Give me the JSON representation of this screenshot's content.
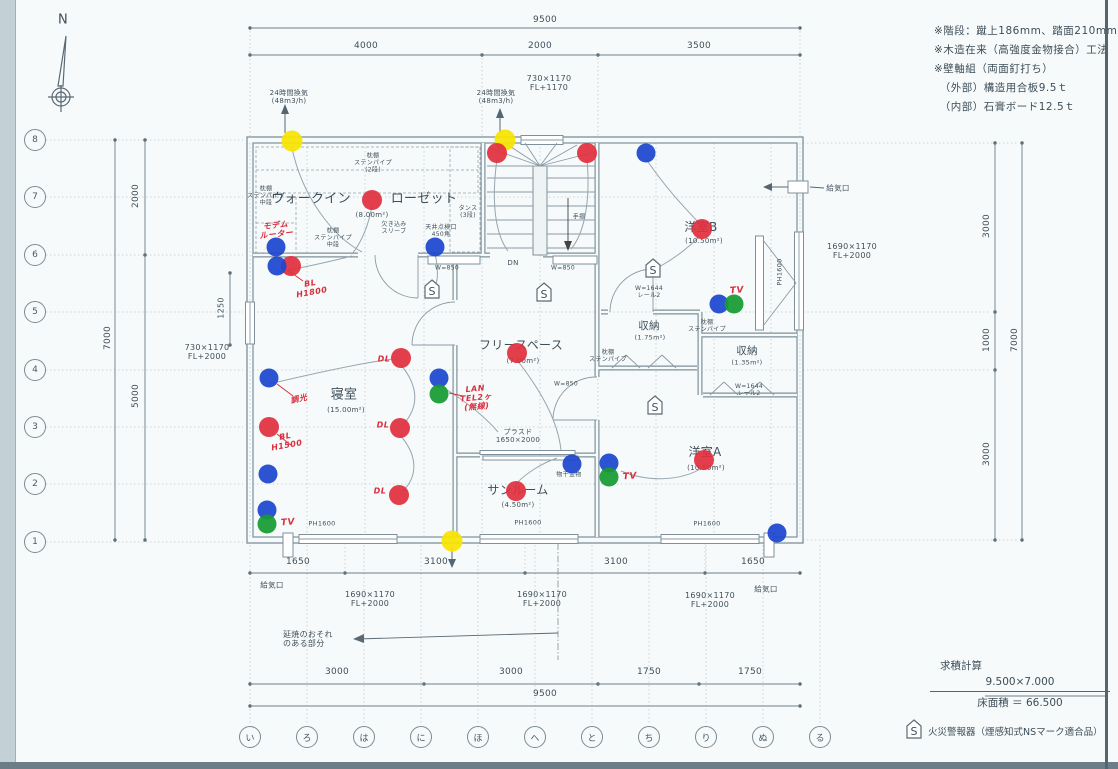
{
  "colors": {
    "red": "#e02f3e",
    "blue": "#1c46cf",
    "green": "#169b32",
    "yellow": "#f6e400",
    "line": "#7e909b",
    "text": "#3f4f5a",
    "hand": "#d9303f"
  },
  "compass": {
    "label": "N"
  },
  "notes": [
    "※階段：蹴上186mm、踏面210mm",
    "※木造在来（高強度金物接合）工法",
    "※壁軸組（両面釘打ち）",
    "　（外部）構造用合板9.5ｔ",
    "　（内部）石膏ボード12.5ｔ"
  ],
  "area_calc": {
    "title": "求積計算",
    "formula": "9.500×7.000",
    "result": "床面積 ＝ 66.500"
  },
  "legend": {
    "symbol": "S",
    "label": "火災警報器（煙感知式NSマーク適合品）"
  },
  "grid": {
    "rows": [
      "8",
      "7",
      "6",
      "5",
      "4",
      "3",
      "2",
      "1"
    ],
    "cols": [
      "い",
      "ろ",
      "は",
      "に",
      "ほ",
      "へ",
      "と",
      "ち",
      "り",
      "ぬ",
      "る"
    ]
  },
  "labels": [
    {
      "n": "dim-top-9500",
      "t": "9500",
      "x": 545,
      "y": 20,
      "s": 9
    },
    {
      "n": "dim-top-4000",
      "t": "4000",
      "x": 366,
      "y": 46,
      "s": 9
    },
    {
      "n": "dim-top-2000",
      "t": "2000",
      "x": 540,
      "y": 46,
      "s": 9
    },
    {
      "n": "dim-top-3500",
      "t": "3500",
      "x": 699,
      "y": 46,
      "s": 9
    },
    {
      "n": "dim-left-2000",
      "t": "2000",
      "x": 136,
      "y": 196,
      "s": 9,
      "r": -90
    },
    {
      "n": "dim-left-7000",
      "t": "7000",
      "x": 108,
      "y": 338,
      "s": 9,
      "r": -90
    },
    {
      "n": "dim-left-5000",
      "t": "5000",
      "x": 136,
      "y": 396,
      "s": 9,
      "r": -90
    },
    {
      "n": "dim-left-1250",
      "t": "1250",
      "x": 221,
      "y": 308,
      "s": 8,
      "r": -90
    },
    {
      "n": "dim-right-3000a",
      "t": "3000",
      "x": 987,
      "y": 226,
      "s": 9,
      "r": -90
    },
    {
      "n": "dim-right-1000",
      "t": "1000",
      "x": 987,
      "y": 340,
      "s": 9,
      "r": -90
    },
    {
      "n": "dim-right-3000b",
      "t": "3000",
      "x": 987,
      "y": 454,
      "s": 9,
      "r": -90
    },
    {
      "n": "dim-right-7000",
      "t": "7000",
      "x": 1015,
      "y": 340,
      "s": 9,
      "r": -90
    },
    {
      "n": "dim-bm-1650-l",
      "t": "1650",
      "x": 298,
      "y": 562,
      "s": 9
    },
    {
      "n": "dim-bm-3100-l",
      "t": "3100",
      "x": 436,
      "y": 562,
      "s": 9
    },
    {
      "n": "dim-bm-3100-r",
      "t": "3100",
      "x": 616,
      "y": 562,
      "s": 9
    },
    {
      "n": "dim-bm-1650-r",
      "t": "1650",
      "x": 753,
      "y": 562,
      "s": 9
    },
    {
      "n": "dim-b-3000-l",
      "t": "3000",
      "x": 337,
      "y": 672,
      "s": 9
    },
    {
      "n": "dim-b-3000-m",
      "t": "3000",
      "x": 511,
      "y": 672,
      "s": 9
    },
    {
      "n": "dim-b-1750-l",
      "t": "1750",
      "x": 649,
      "y": 672,
      "s": 9
    },
    {
      "n": "dim-b-1750-r",
      "t": "1750",
      "x": 750,
      "y": 672,
      "s": 9
    },
    {
      "n": "dim-b-9500",
      "t": "9500",
      "x": 545,
      "y": 694,
      "s": 9
    },
    {
      "n": "win-top",
      "t": "730×1170\nFL+1170",
      "x": 549,
      "y": 83,
      "s": 8
    },
    {
      "n": "win-left",
      "t": "730×1170\nFL+2000",
      "x": 207,
      "y": 352,
      "s": 8
    },
    {
      "n": "win-right",
      "t": "1690×1170\nFL+2000",
      "x": 852,
      "y": 251,
      "s": 8
    },
    {
      "n": "win-b1",
      "t": "1690×1170\nFL+2000",
      "x": 370,
      "y": 599,
      "s": 8
    },
    {
      "n": "win-b2",
      "t": "1690×1170\nFL+2000",
      "x": 542,
      "y": 599,
      "s": 8
    },
    {
      "n": "win-b3",
      "t": "1690×1170\nFL+2000",
      "x": 710,
      "y": 600,
      "s": 8
    },
    {
      "n": "ph-b1",
      "t": "PH1600",
      "x": 322,
      "y": 524,
      "s": 6.5
    },
    {
      "n": "ph-b2",
      "t": "PH1600",
      "x": 528,
      "y": 523,
      "s": 6.5
    },
    {
      "n": "ph-b3",
      "t": "PH1600",
      "x": 707,
      "y": 524,
      "s": 6.5
    },
    {
      "n": "ph-right",
      "t": "PH1600",
      "x": 780,
      "y": 272,
      "s": 6.5,
      "r": -90
    },
    {
      "n": "door-sunroom",
      "t": "プラスド\n1650×2000",
      "x": 518,
      "y": 436,
      "s": 7
    },
    {
      "n": "counter-a",
      "t": "W=850",
      "x": 447,
      "y": 269,
      "s": 6
    },
    {
      "n": "counter-b",
      "t": "W=850",
      "x": 563,
      "y": 269,
      "s": 6
    },
    {
      "n": "counter-c",
      "t": "W=850",
      "x": 566,
      "y": 385,
      "s": 6
    },
    {
      "n": "rail-a",
      "t": "W=1644\nレール2",
      "x": 649,
      "y": 293,
      "s": 6
    },
    {
      "n": "rail-b",
      "t": "W=1644\nレール2",
      "x": 749,
      "y": 391,
      "s": 6
    },
    {
      "n": "vent-24h-l",
      "t": "24時間換気\n(48m3/h)",
      "x": 289,
      "y": 97,
      "s": 7
    },
    {
      "n": "vent-24h-r",
      "t": "24時間換気\n(48m3/h)",
      "x": 496,
      "y": 97,
      "s": 7
    },
    {
      "n": "kyukiko-tr",
      "t": "給気口",
      "x": 838,
      "y": 189,
      "s": 7.5
    },
    {
      "n": "kyukiko-bl",
      "t": "給気口",
      "x": 272,
      "y": 586,
      "s": 7.5
    },
    {
      "n": "kyukiko-br",
      "t": "給気口",
      "x": 766,
      "y": 590,
      "s": 7.5
    },
    {
      "n": "room-wic-1",
      "t": "ウォークイン",
      "x": 311,
      "y": 200,
      "s": 13
    },
    {
      "n": "room-wic-2",
      "t": "ローゼット",
      "x": 424,
      "y": 200,
      "s": 13
    },
    {
      "n": "area-wic",
      "t": "(8.00m²)",
      "x": 372,
      "y": 215,
      "s": 7
    },
    {
      "n": "room-shinshitsu",
      "t": "寝室",
      "x": 344,
      "y": 396,
      "s": 13
    },
    {
      "n": "area-shinshitsu",
      "t": "(15.00m²)",
      "x": 346,
      "y": 410,
      "s": 7
    },
    {
      "n": "room-freespace",
      "t": "フリースペース",
      "x": 521,
      "y": 346,
      "s": 12
    },
    {
      "n": "area-freespace",
      "t": "(7.00m²)",
      "x": 523,
      "y": 361,
      "s": 7
    },
    {
      "n": "room-yoshitsu-b",
      "t": "洋室B",
      "x": 701,
      "y": 228,
      "s": 12
    },
    {
      "n": "area-yoshitsu-b",
      "t": "(10.50m²)",
      "x": 704,
      "y": 241,
      "s": 7
    },
    {
      "n": "room-shuno-1",
      "t": "収納",
      "x": 649,
      "y": 326,
      "s": 10.5
    },
    {
      "n": "area-shuno-1",
      "t": "(1.75m²)",
      "x": 650,
      "y": 338,
      "s": 6.5
    },
    {
      "n": "room-shuno-2",
      "t": "収納",
      "x": 747,
      "y": 351,
      "s": 10.5
    },
    {
      "n": "area-shuno-2",
      "t": "(1.35m²)",
      "x": 747,
      "y": 363,
      "s": 6.5
    },
    {
      "n": "room-yoshitsu-a",
      "t": "洋室A",
      "x": 705,
      "y": 453,
      "s": 12
    },
    {
      "n": "area-yoshitsu-a",
      "t": "(10.50m²)",
      "x": 706,
      "y": 468,
      "s": 7
    },
    {
      "n": "room-sunroom",
      "t": "サンルーム",
      "x": 518,
      "y": 491,
      "s": 12
    },
    {
      "n": "area-sunroom",
      "t": "(4.50m²)",
      "x": 518,
      "y": 505,
      "s": 7
    },
    {
      "n": "shelf-1",
      "t": "枕棚\nステンパイプ\n(2段)",
      "x": 373,
      "y": 164,
      "s": 6
    },
    {
      "n": "shelf-2",
      "t": "枕棚\nステンパイプ\n中段",
      "x": 266,
      "y": 197,
      "s": 6
    },
    {
      "n": "shelf-3",
      "t": "枕棚\nステンパイプ\n中段",
      "x": 333,
      "y": 239,
      "s": 6
    },
    {
      "n": "shelf-4",
      "t": "枕棚\nステンパイプ",
      "x": 608,
      "y": 357,
      "s": 6
    },
    {
      "n": "shelf-5",
      "t": "枕棚\nステンパイプ",
      "x": 707,
      "y": 327,
      "s": 6
    },
    {
      "n": "tansu",
      "t": "タンス\n(3段)",
      "x": 468,
      "y": 213,
      "s": 6
    },
    {
      "n": "tenkenko",
      "t": "天井点検口\n450角",
      "x": 441,
      "y": 232,
      "s": 6
    },
    {
      "n": "kakikomi",
      "t": "欠き込み\nスリーブ",
      "x": 394,
      "y": 229,
      "s": 6
    },
    {
      "n": "tesuri",
      "t": "手摺",
      "x": 579,
      "y": 218,
      "s": 6
    },
    {
      "n": "dn",
      "t": "DN",
      "x": 513,
      "y": 263,
      "s": 7
    },
    {
      "n": "monohoshi",
      "t": "物干金物",
      "x": 569,
      "y": 476,
      "s": 6
    },
    {
      "n": "enshou",
      "t": "延焼のおそれ\nのある部分",
      "x": 283,
      "y": 639,
      "s": 8,
      "a": "l"
    },
    {
      "n": "hand-modem",
      "t": "モデム\nルーター",
      "x": 276,
      "y": 230,
      "s": 8,
      "c": "hand",
      "r": -6
    },
    {
      "n": "hand-bl1800",
      "t": "BL\nH1800",
      "x": 311,
      "y": 288,
      "s": 8,
      "c": "hand",
      "r": -10
    },
    {
      "n": "hand-chokou",
      "t": "調光",
      "x": 299,
      "y": 399,
      "s": 8,
      "c": "hand",
      "r": -12
    },
    {
      "n": "hand-bl1500",
      "t": "BL\nH1500",
      "x": 286,
      "y": 441,
      "s": 8,
      "c": "hand",
      "r": -10
    },
    {
      "n": "hand-dl-1",
      "t": "DL",
      "x": 384,
      "y": 359,
      "s": 8,
      "c": "hand"
    },
    {
      "n": "hand-dl-2",
      "t": "DL",
      "x": 383,
      "y": 425,
      "s": 8,
      "c": "hand"
    },
    {
      "n": "hand-dl-3",
      "t": "DL",
      "x": 380,
      "y": 491,
      "s": 8,
      "c": "hand"
    },
    {
      "n": "hand-lan",
      "t": "LAN\nTEL2ヶ\n(無線)",
      "x": 476,
      "y": 398,
      "s": 8,
      "c": "hand",
      "r": -5
    },
    {
      "n": "hand-tv-1",
      "t": "TV",
      "x": 737,
      "y": 291,
      "s": 9,
      "c": "hand",
      "r": -5
    },
    {
      "n": "hand-tv-2",
      "t": "TV",
      "x": 630,
      "y": 477,
      "s": 9,
      "c": "hand",
      "r": -5
    },
    {
      "n": "hand-tv-3",
      "t": "TV",
      "x": 288,
      "y": 523,
      "s": 9,
      "c": "hand",
      "r": -5
    },
    {
      "n": "compass-label",
      "t": "N",
      "x": 63,
      "y": 21,
      "s": 13
    }
  ],
  "marks": {
    "dots": [
      {
        "c": "y",
        "x": 292,
        "y": 141
      },
      {
        "c": "y",
        "x": 505,
        "y": 140
      },
      {
        "c": "y",
        "x": 452,
        "y": 541
      },
      {
        "c": "r",
        "x": 372,
        "y": 200
      },
      {
        "c": "r",
        "x": 497,
        "y": 153
      },
      {
        "c": "r",
        "x": 587,
        "y": 153
      },
      {
        "c": "r",
        "x": 702,
        "y": 229
      },
      {
        "c": "r",
        "x": 291,
        "y": 266
      },
      {
        "c": "r",
        "x": 269,
        "y": 427
      },
      {
        "c": "r",
        "x": 401,
        "y": 358
      },
      {
        "c": "r",
        "x": 400,
        "y": 428
      },
      {
        "c": "r",
        "x": 399,
        "y": 495
      },
      {
        "c": "r",
        "x": 517,
        "y": 353
      },
      {
        "c": "r",
        "x": 516,
        "y": 491
      },
      {
        "c": "r",
        "x": 704,
        "y": 460
      },
      {
        "c": "b",
        "x": 276,
        "y": 247
      },
      {
        "c": "b",
        "x": 277,
        "y": 266
      },
      {
        "c": "b",
        "x": 435,
        "y": 247
      },
      {
        "c": "b",
        "x": 646,
        "y": 153
      },
      {
        "c": "b",
        "x": 269,
        "y": 378
      },
      {
        "c": "b",
        "x": 268,
        "y": 474
      },
      {
        "c": "b",
        "x": 267,
        "y": 510
      },
      {
        "c": "b",
        "x": 439,
        "y": 378
      },
      {
        "c": "b",
        "x": 572,
        "y": 464
      },
      {
        "c": "b",
        "x": 609,
        "y": 463
      },
      {
        "c": "b",
        "x": 719,
        "y": 304
      },
      {
        "c": "b",
        "x": 777,
        "y": 533
      },
      {
        "c": "g",
        "x": 267,
        "y": 524
      },
      {
        "c": "g",
        "x": 439,
        "y": 394
      },
      {
        "c": "g",
        "x": 609,
        "y": 477
      },
      {
        "c": "g",
        "x": 734,
        "y": 304
      }
    ],
    "fire_alarms": [
      {
        "x": 432,
        "y": 291
      },
      {
        "x": 544,
        "y": 294
      },
      {
        "x": 653,
        "y": 270
      },
      {
        "x": 655,
        "y": 407
      }
    ]
  }
}
